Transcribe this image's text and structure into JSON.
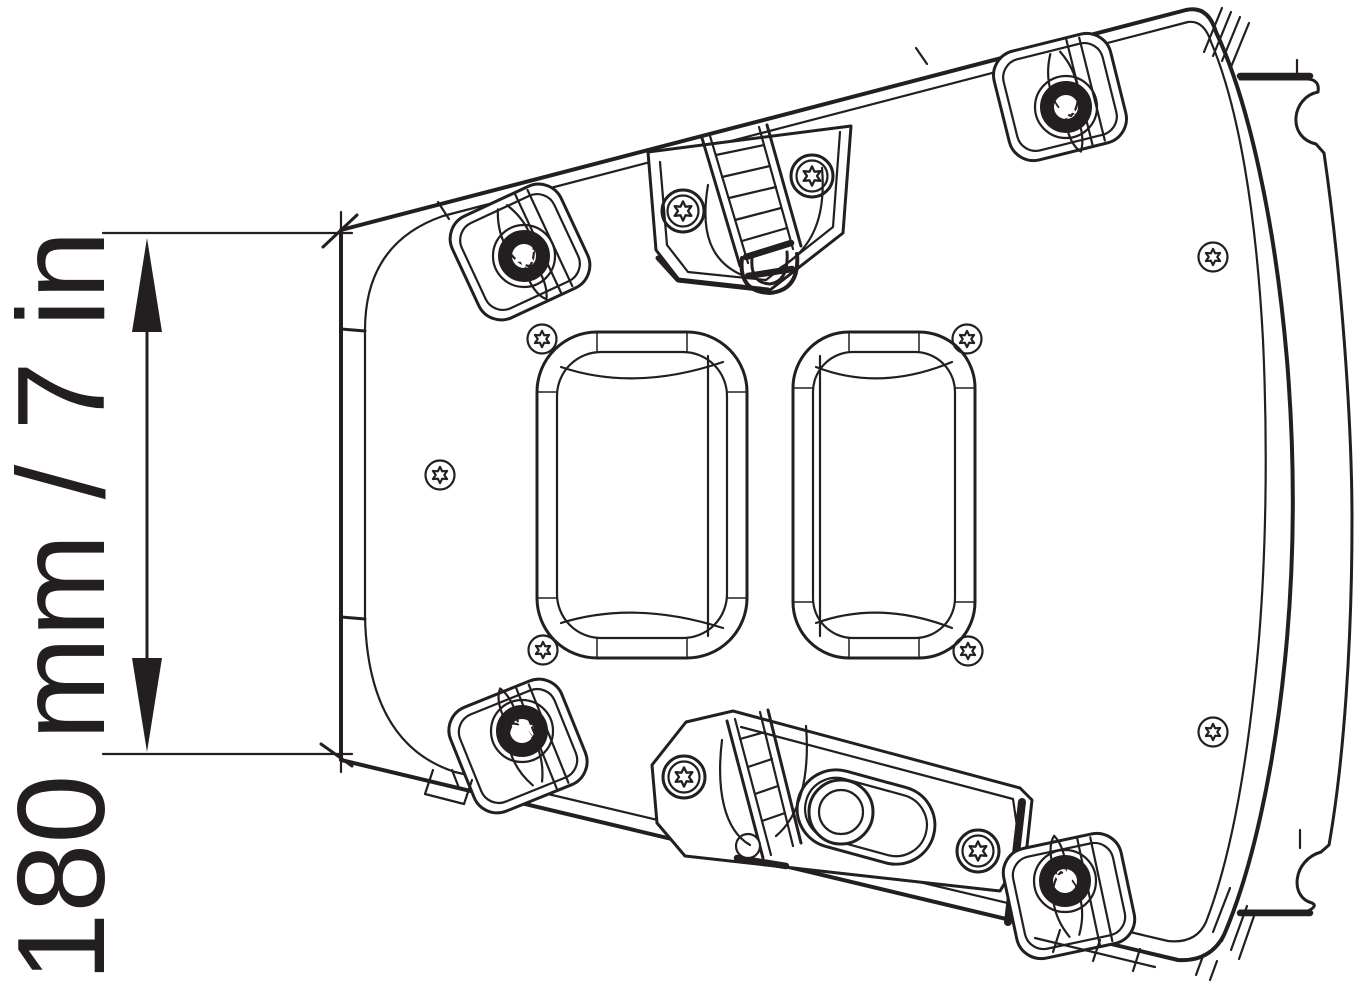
{
  "colors": {
    "ink": "#231f20",
    "paper": "#ffffff"
  },
  "dimension": {
    "label": "180 mm / 7 in",
    "value_mm": 180,
    "value_in": 7,
    "orientation": "vertical",
    "arrow_style": "double-headed"
  },
  "drawing": {
    "subject": "mounting-plate-rear-view",
    "features": [
      "corner-clip-top-left",
      "corner-clip-top-right",
      "corner-clip-bottom-left",
      "corner-clip-bottom-right",
      "hinge-strap-top-center",
      "latch-strap-bottom-center",
      "latch-slot-with-knob",
      "handle-cutout-left",
      "handle-cutout-right",
      "side-flange-right",
      "hatch-marks"
    ]
  },
  "screws": {
    "heavy": [
      {
        "x": 524,
        "y": 256
      },
      {
        "x": 1066,
        "y": 107
      },
      {
        "x": 522,
        "y": 731
      },
      {
        "x": 1065,
        "y": 881
      }
    ],
    "medium": [
      {
        "x": 683,
        "y": 211
      },
      {
        "x": 812,
        "y": 176
      },
      {
        "x": 684,
        "y": 777
      },
      {
        "x": 978,
        "y": 851
      }
    ],
    "small": [
      {
        "x": 542,
        "y": 339
      },
      {
        "x": 967,
        "y": 339
      },
      {
        "x": 543,
        "y": 650
      },
      {
        "x": 968,
        "y": 651
      },
      {
        "x": 440,
        "y": 475
      },
      {
        "x": 1213,
        "y": 257
      },
      {
        "x": 1213,
        "y": 732
      }
    ]
  }
}
